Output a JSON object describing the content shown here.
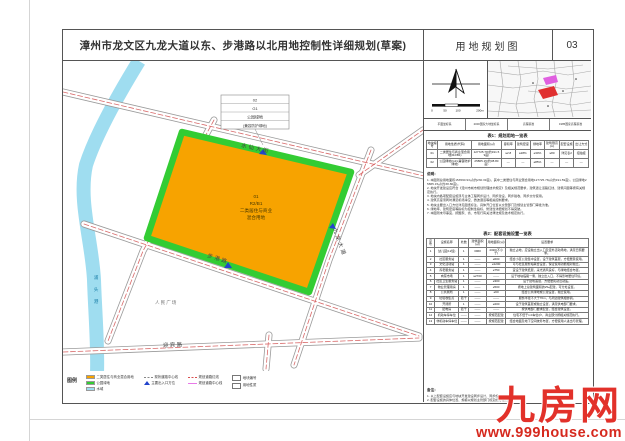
{
  "page": {
    "title": "漳州市龙文区九龙大道以东、步港路以北用地控制性详细规划(草案)",
    "sheet_name": "用地规划图",
    "sheet_no": "03"
  },
  "map": {
    "river_chars": [
      "浦",
      "头",
      "港"
    ],
    "labels": {
      "road_top": "水仙大街",
      "road_right": "九龙大道",
      "road_bottom": "步港路",
      "road_south": "迎宾路",
      "square": "人民广场"
    },
    "parcel_label": {
      "l1": "01",
      "l2": "R2/B1",
      "l3": "二类居住与商业",
      "l4": "混合用地"
    },
    "callout": {
      "l1": "02",
      "l2": "G1",
      "l3": "公园绿地",
      "l4": "(兼容防护绿地)"
    },
    "colors": {
      "parcel": "#F7A300",
      "green_edge": "#33CC33",
      "river": "#9FDDF0",
      "road_dash": "#D96A6A"
    }
  },
  "legend": {
    "title": "图例",
    "columns": [
      [
        {
          "swatch": "orange",
          "label": "二类居住与商业混合用地"
        },
        {
          "swatch": "green",
          "label": "公园绿地"
        },
        {
          "swatch": "cyan",
          "label": "水域"
        }
      ],
      [
        {
          "swatch": "gray-dash",
          "label": "现状道路中心线"
        },
        {
          "swatch": "blue-triangle",
          "label": "主要出入口方位"
        }
      ],
      [
        {
          "swatch": "red-dash",
          "label": "规划道路红线"
        },
        {
          "swatch": "pink-line",
          "label": "规划道路中心线"
        }
      ],
      [
        {
          "swatch": "box",
          "label": "地块编号"
        },
        {
          "swatch": "box",
          "label": "用地性质"
        }
      ]
    ]
  },
  "panel": {
    "info_cells": [
      "平面坐标系",
      "2000国家大地坐标系",
      "高程基准",
      "1985国家高程基准"
    ],
    "scalebar_labels": [
      "0",
      "50",
      "100",
      "200m"
    ],
    "table1": {
      "caption": "表1：规划用地一览表",
      "columns": [
        "地块编号",
        "用地性质(代码)",
        "用地面积(㎡)",
        "容积率",
        "建筑密度",
        "绿地率",
        "建筑限高(m)",
        "配套设施",
        "出让方式"
      ],
      "rows": [
        [
          "01",
          "二类居住与商业混合用地(R2/B1)",
          "127725.78(约191.59亩)",
          "≤2.8",
          "≤28%",
          "≥30%",
          "≤80",
          "详见表2",
          "招拍挂"
        ],
        [
          "02",
          "公园绿地(G1)(兼容防护绿地)",
          "25865.15(约38.80亩)",
          "—",
          "—",
          "≥85%",
          "—",
          "—",
          "—"
        ]
      ]
    },
    "notes_title": "说明：",
    "notes": [
      "1. 本图则总用地面积153590.93㎡(约230.39亩)，其中二类居住与商业混合用地127725.78㎡(约191.59亩)，公园绿地25865.15㎡(约38.80亩)。",
      "2. 地块开发建设应符合《漳州市城市规划管理技术规定》及相关规范要求，建筑退让道路红线、建筑间距等按有关规定执行。",
      "3. 地块内各项配套设施须与主体工程同步设计、同步建设、同步验收、同步交付使用。",
      "4. 建筑高度须同时满足机场净空、微波通道等相关控制要求。",
      "5. 地块主要出入口方位详见图纸标注，具体开口位置以交警部门及规划主管部门审批为准。",
      "6. 绿地率、建筑密度等指标为控制性指标，修建性详细规划不得突破。",
      "7. 本图则未尽事宜，按国家、省、市现行有关法律法规及技术规定执行。"
    ],
    "table2": {
      "caption": "表2：配套设施设置一览表",
      "columns": [
        "序号",
        "设施名称",
        "处数",
        "建筑面积(㎡)",
        "用地面积(㎡)",
        "设置要求"
      ],
      "rows": [
        [
          "1",
          "幼儿园(12班)",
          "1",
          "3960",
          "4320(不小于)",
          "独立占地，应设独立出入口及室外活动场地，满足日照要求。"
        ],
        [
          "2",
          "社区服务站",
          "1",
          "——",
          "≥600",
          "结合小区公建集中设置，设于建筑首层，方便居民使用。"
        ],
        [
          "3",
          "文化活动站",
          "1",
          "——",
          "≥1200",
          "可与社区服务站联合设置，保证使用功能相对独立。"
        ],
        [
          "4",
          "养老服务站",
          "1",
          "——",
          "≥750",
          "宜设于建筑低层，采光通风良好，与绿地结合布置。"
        ],
        [
          "5",
          "肉菜市场",
          "1",
          "≤2700",
          "——",
          "设于地块临路一侧，独立出入口，不得影响居住环境。"
        ],
        [
          "6",
          "社区卫生服务站",
          "1",
          "——",
          "≥300",
          "设于建筑首层，方便居民就近就医。"
        ],
        [
          "7",
          "物业管理用房",
          "1",
          "——",
          "≥500",
          "按地上总建筑面积的2‰配建，可分处设置。"
        ],
        [
          "8",
          "公共厕所",
          "1",
          "——",
          "≥60",
          "结合公共绿地或公建设置，独立使用。"
        ],
        [
          "9",
          "垃圾收集点",
          "若干",
          "——",
          "——",
          "服务半径不大于70m，与周边建筑相协调。"
        ],
        [
          "10",
          "开闭所",
          "1",
          "——",
          "≥200",
          "设于建筑首层或独立设置，满足供电部门要求。"
        ],
        [
          "11",
          "配电房",
          "若干",
          "——",
          "——",
          "按供电部门要求配置，结合建筑设置。"
        ],
        [
          "12",
          "机动车停车位",
          "——",
          "——",
          "按规范配建",
          "住宅不低于1.0车位/户，商业部分按相关规范执行。"
        ],
        [
          "13",
          "非机动车停车位",
          "——",
          "——",
          "按规范配建",
          "结合地面及地下空间统筹布置，方便使用人进出与管理。"
        ]
      ]
    },
    "remarks_title": "备注：",
    "remarks": [
      "1. 以上配套设施应与地块开发建设同步设计、同步施工、同步交付使用。",
      "2. 配套设施的具体位置、规模以规划主管部门核定的方案为准。"
    ]
  },
  "watermark": {
    "logo": "九房网",
    "url": "www.999house.com"
  }
}
